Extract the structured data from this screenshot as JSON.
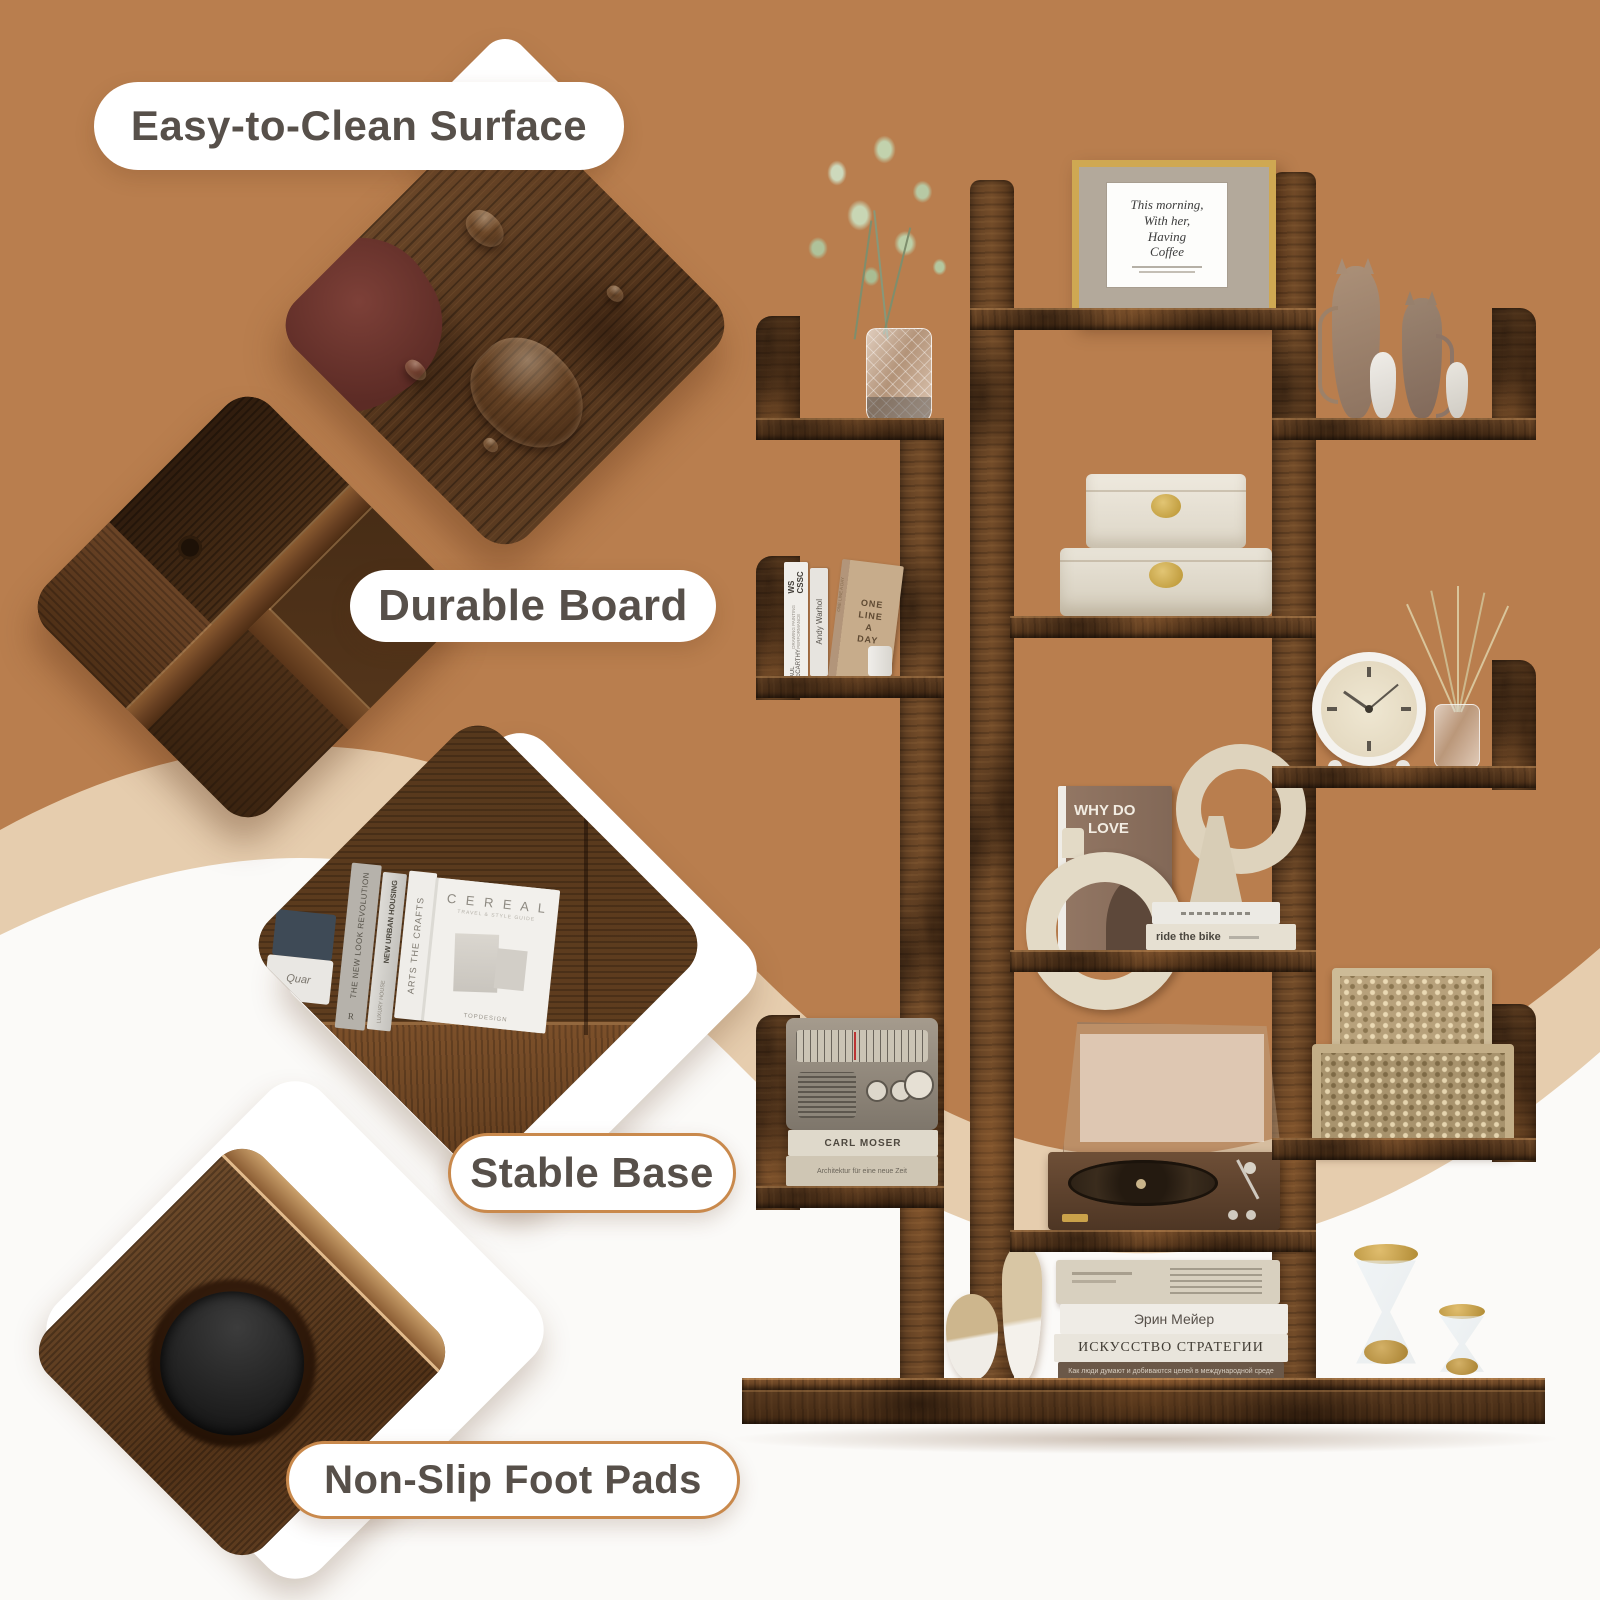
{
  "colors": {
    "background": "#b97e4e",
    "band_beige": "#e6cdae",
    "swoosh_white": "#fbfaf8",
    "pill_text": "#57504a",
    "pill_border": "#c9894c",
    "wood_dark": "#54351b",
    "gold": "#c9a23e"
  },
  "feature_pills": {
    "easy_clean": {
      "label": "Easy-to-Clean Surface"
    },
    "durable_board": {
      "label": "Durable Board"
    },
    "stable_base": {
      "label": "Stable Base"
    },
    "non_slip": {
      "label": "Non-Slip Foot Pads"
    }
  },
  "photos": {
    "easy_clean_surface": {
      "name": "wet-wood-surface-with-water-drops"
    },
    "durable_board": {
      "name": "shelf-corner-joint-closeup"
    },
    "stable_base": {
      "name": "books-standing-on-shelf-corner",
      "books": {
        "cover_title": "C E R E A L",
        "cover_sub": "TRAVEL & STYLE GUIDE",
        "cover_brand": "TOPDESIGN",
        "spine_white": "ARTS THE CRAFTS",
        "spine_silver": "NEW URBAN HOUSING",
        "spine_silver_sub": "LUXURY HOUSE",
        "spine_gray": "THE NEW LOOK REVOLUTION",
        "spine_gray_initial": "R",
        "box_text": "Quar"
      }
    },
    "non_slip_foot_pads": {
      "name": "black-felt-foot-pad-under-board"
    }
  },
  "shelf": {
    "framed_print": {
      "line1": "This morning,",
      "line2": "With her,",
      "line3": "Having",
      "line4": "Coffee"
    },
    "left_books": {
      "spine1_title": "WS CSSC",
      "spine1_sub": "DRAWING PAINTING PERFORMANCE",
      "spine1_author": "PAUL McCARTHY",
      "spine2": "Andy Warhol",
      "spine3_l1": "ONE",
      "spine3_l2": "LINE",
      "spine3_l3": "A",
      "spine3_l4": "DAY",
      "spine3_edge": "ONE LINE A DAY"
    },
    "center_display": {
      "why_book_l1": "WHY DO",
      "why_book_l2": "LOVE",
      "stack_bottom": "ride the bike"
    },
    "radio_books": {
      "top": "CARL MOSER",
      "bottom": "Architektur für eine neue Zeit"
    },
    "base_books": {
      "author": "Эрин Мейер",
      "title": "ИСКУССТВО СТРАТЕГИИ",
      "subtitle": "Как люди думают и добиваются целей в международной среде"
    }
  }
}
